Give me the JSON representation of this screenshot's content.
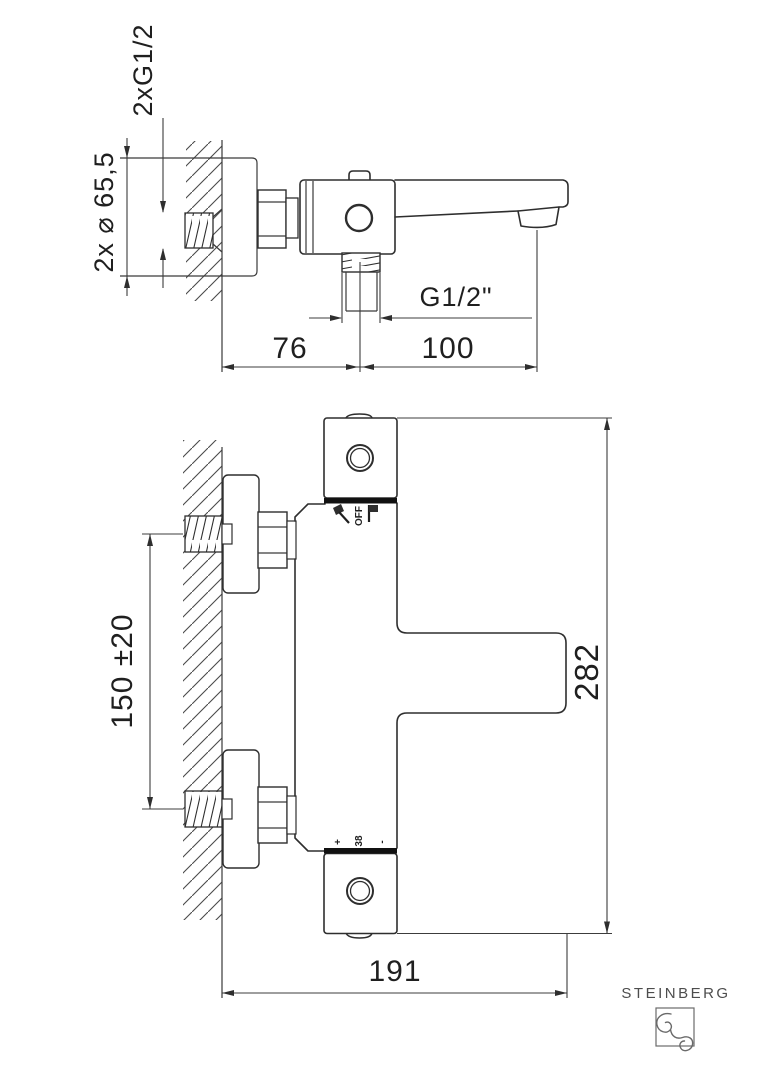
{
  "side_view": {
    "inlet_thread_label": "2xG1/2",
    "escutcheon_diameter_label": "2x ⌀ 65,5",
    "outlet_thread_label": "G1/2\"",
    "wall_to_outlet": "76",
    "outlet_to_spout_tip": "100"
  },
  "front_view": {
    "inlet_spacing": "150 ±20",
    "overall_height": "282",
    "overall_depth": "191",
    "diverter": {
      "off_label": "OFF",
      "shower_icon": "hand-shower-icon",
      "spout_icon": "bath-spout-icon"
    },
    "thermostat": {
      "plus_label": "+",
      "temperature_label": "38",
      "minus_label": "-"
    }
  },
  "brand": {
    "name": "STEINBERG"
  }
}
